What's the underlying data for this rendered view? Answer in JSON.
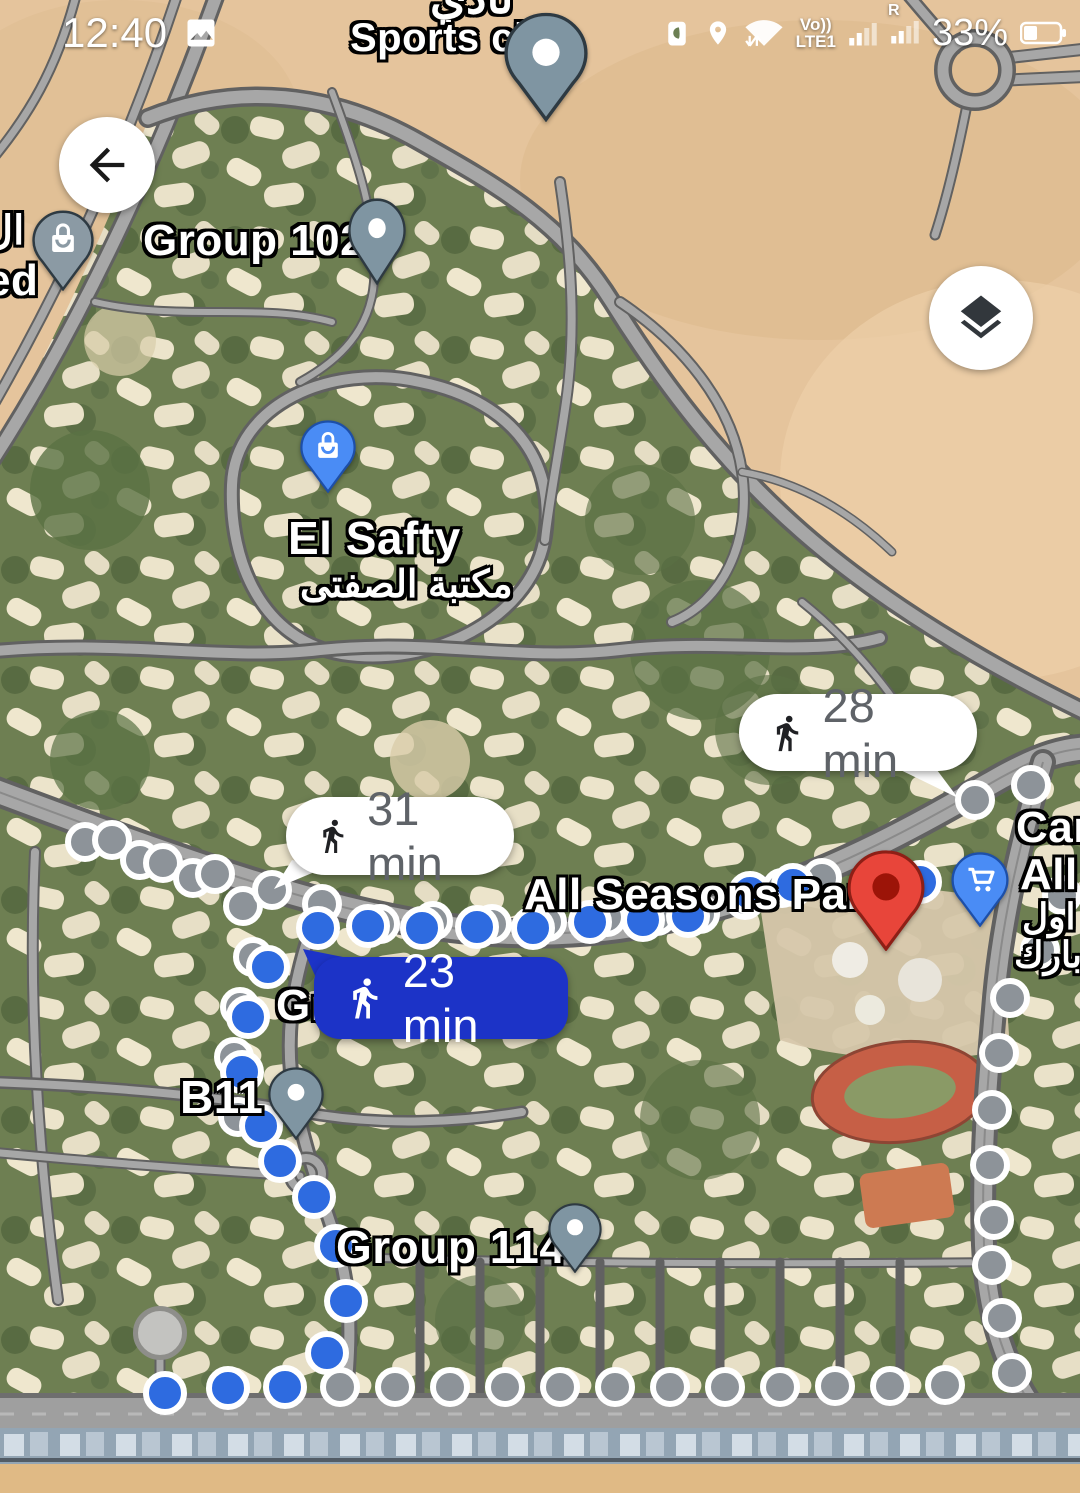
{
  "status_bar": {
    "time": "12:40",
    "volte_label": "Vo))",
    "network_label": "LTE1",
    "sim2_label": "R",
    "battery_pct": "33%"
  },
  "labels": {
    "top_arabic_partial": "نادي",
    "sports_club": "Sports club",
    "group_102": "Group 102",
    "left_arabic_partial": "ال",
    "left_ed_partial": "ed",
    "el_safty": "El Safty",
    "el_safty_arabic": "مكتبة الصفتى",
    "all_seasons_park": "All Seasons Park",
    "car_partial": "Car",
    "all_partial": "All",
    "arabic_awel_partial": "اول",
    "arabic_park_partial": "بارك",
    "gr_partial": "Gr",
    "b11": "B11",
    "group_114": "Group 114"
  },
  "route_bubbles": {
    "walk_28": {
      "duration": "28 min",
      "mode": "walking",
      "selected": false
    },
    "walk_31": {
      "duration": "31 min",
      "mode": "walking",
      "selected": false
    },
    "walk_23": {
      "duration": "23 min",
      "mode": "walking",
      "selected": true
    }
  },
  "colors": {
    "selected_route_bubble": "#1c33c7",
    "selected_route_dot": "#2e6be0",
    "alternate_route_dot": "#8d9399",
    "poi_pin_gray": "#7f95a2",
    "poi_pin_blue": "#4a8cf5",
    "destination_pin_red": "#e8453a"
  },
  "route_dots": {
    "alternate_gray": [
      [
        85,
        842
      ],
      [
        112,
        840
      ],
      [
        140,
        860
      ],
      [
        163,
        863
      ],
      [
        193,
        878
      ],
      [
        215,
        874
      ],
      [
        243,
        906
      ],
      [
        272,
        890
      ],
      [
        322,
        904
      ],
      [
        380,
        924
      ],
      [
        433,
        921
      ],
      [
        492,
        924
      ],
      [
        547,
        922
      ],
      [
        607,
        917
      ],
      [
        657,
        916
      ],
      [
        700,
        914
      ],
      [
        745,
        900
      ],
      [
        782,
        888
      ],
      [
        822,
        878
      ],
      [
        975,
        800
      ],
      [
        1031,
        785
      ],
      [
        1062,
        895
      ],
      [
        1040,
        950
      ],
      [
        1010,
        998
      ],
      [
        999,
        1053
      ],
      [
        992,
        1110
      ],
      [
        990,
        1165
      ],
      [
        994,
        1220
      ],
      [
        992,
        1265
      ],
      [
        1002,
        1318
      ],
      [
        1012,
        1373
      ],
      [
        945,
        1385
      ],
      [
        890,
        1386
      ],
      [
        835,
        1386
      ],
      [
        780,
        1387
      ],
      [
        725,
        1387
      ],
      [
        670,
        1387
      ],
      [
        615,
        1387
      ],
      [
        560,
        1387
      ],
      [
        505,
        1387
      ],
      [
        450,
        1387
      ],
      [
        395,
        1387
      ],
      [
        340,
        1387
      ],
      [
        253,
        957
      ],
      [
        240,
        1007
      ],
      [
        234,
        1057
      ],
      [
        238,
        1117
      ]
    ],
    "selected_blue": [
      [
        318,
        928
      ],
      [
        368,
        926
      ],
      [
        422,
        928
      ],
      [
        477,
        927
      ],
      [
        533,
        928
      ],
      [
        590,
        922
      ],
      [
        643,
        920
      ],
      [
        688,
        916
      ],
      [
        750,
        893
      ],
      [
        793,
        885
      ],
      [
        920,
        882
      ],
      [
        268,
        967
      ],
      [
        248,
        1017
      ],
      [
        242,
        1072
      ],
      [
        261,
        1126
      ],
      [
        280,
        1161
      ],
      [
        314,
        1197
      ],
      [
        336,
        1246
      ],
      [
        346,
        1301
      ],
      [
        327,
        1353
      ],
      [
        285,
        1387
      ],
      [
        228,
        1388
      ],
      [
        165,
        1393
      ]
    ],
    "origin": [
      160,
      1333
    ]
  }
}
